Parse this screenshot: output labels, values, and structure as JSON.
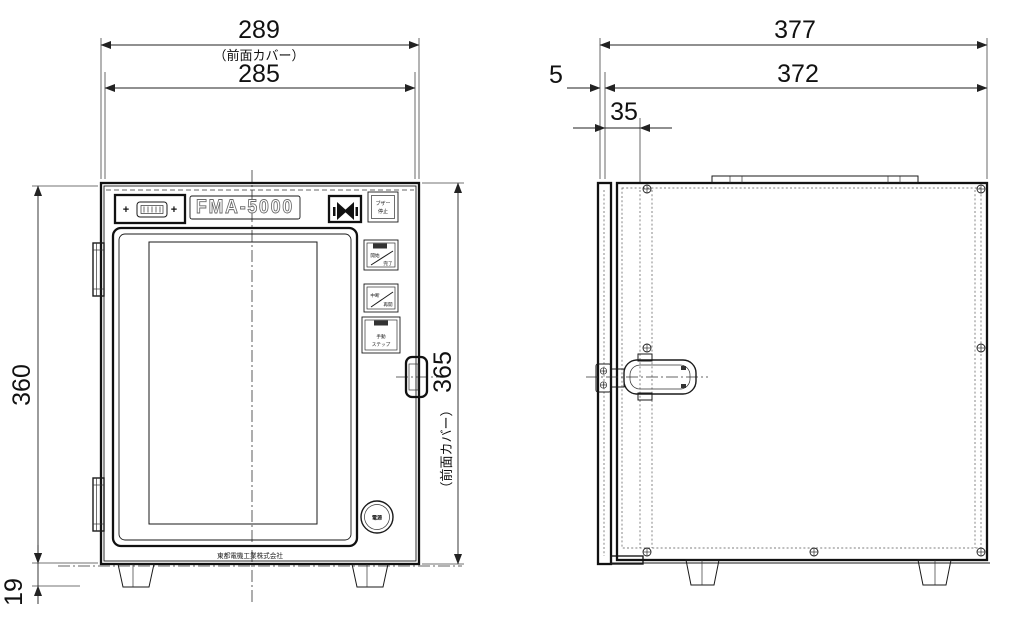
{
  "drawing": {
    "front_view": {
      "dimensions": {
        "cover_width": "289",
        "cover_width_note": "（前面カバー）",
        "body_width": "285",
        "body_height": "360",
        "foot_height": "19",
        "cover_height": "365",
        "cover_height_note": "（前面カバー）"
      },
      "control_panel": {
        "model_label": "FMA-5000",
        "plus_left": "+",
        "plus_right": "+",
        "buzzer_stop_button": {
          "line1": "ブザー",
          "line2": "停止"
        }
      },
      "side_buttons": {
        "start_finish": {
          "upper": "開始",
          "lower": "完了"
        },
        "pause_resume": {
          "upper": "中断",
          "lower": "再開"
        },
        "manual_step": {
          "line1": "手動",
          "line2": "ステップ"
        }
      },
      "power_button_label": "電源",
      "company_label": "東都電機工業株式会社"
    },
    "side_view": {
      "dimensions": {
        "total_depth": "377",
        "body_depth": "372",
        "cover_thickness": "5",
        "latch_offset": "35"
      }
    }
  }
}
